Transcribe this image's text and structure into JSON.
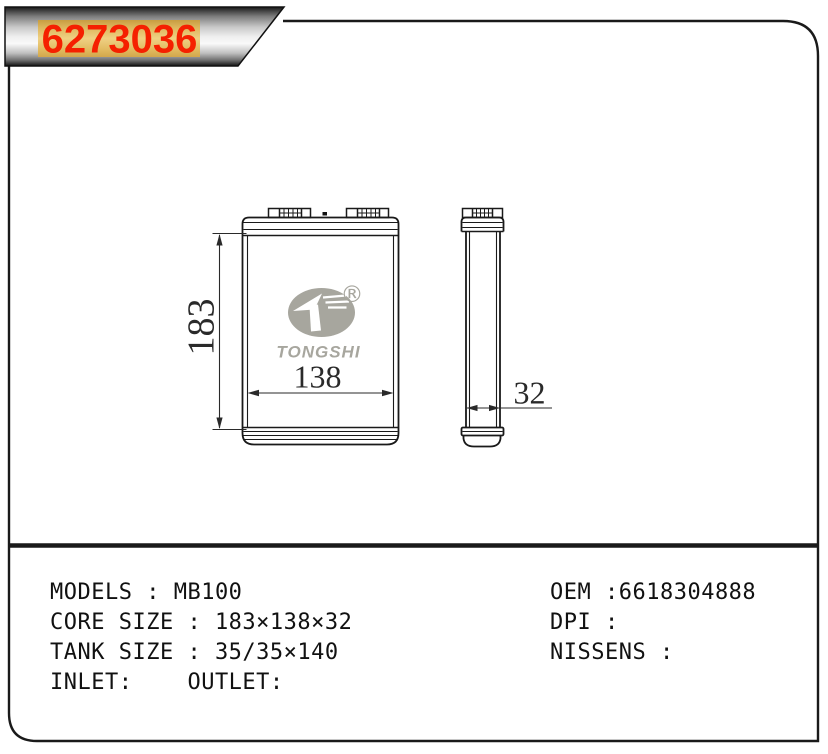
{
  "banner": {
    "part_number": "6273036"
  },
  "colors": {
    "banner_text": "#f52000",
    "banner_gold_mid": "#efd083",
    "logo_gray": "#a7a69e",
    "line": "#1a1a1a",
    "dimension": "#2a2a2a"
  },
  "drawing": {
    "front_view": {
      "height_label": "183",
      "width_label": "138"
    },
    "side_view": {
      "depth_label": "32"
    },
    "logo": {
      "brand": "TONGSHI",
      "registered_mark": "®"
    }
  },
  "specs": {
    "left_lines": [
      "MODELS : MB100",
      "CORE SIZE : 183×138×32",
      "TANK SIZE : 35/35×140",
      "INLET:    OUTLET:"
    ],
    "right_lines": [
      "OEM :6618304888",
      "DPI :",
      "NISSENS :"
    ]
  }
}
